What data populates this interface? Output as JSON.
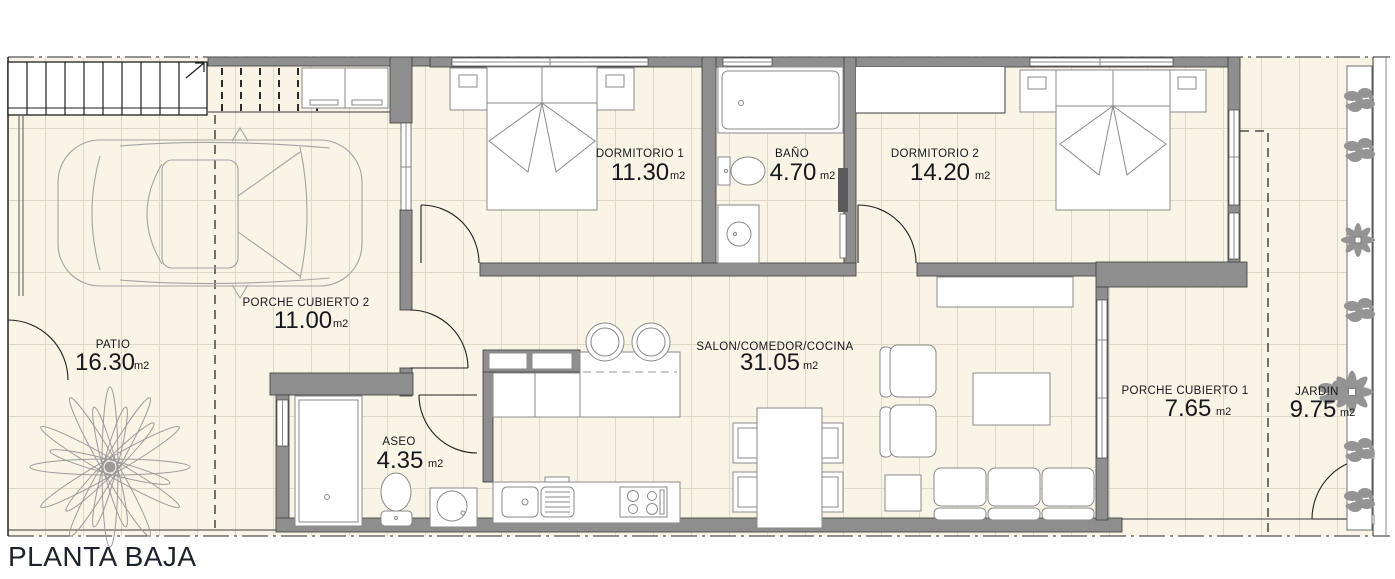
{
  "title": "PLANTA BAJA",
  "rooms": {
    "patio": {
      "name": "PATIO",
      "area": "16.30",
      "unit": "m2"
    },
    "porche2": {
      "name": "PORCHE CUBIERTO 2",
      "area": "11.00",
      "unit": "m2"
    },
    "dormitorio1": {
      "name": "DORMITORIO 1",
      "area": "11.30",
      "unit": "m2"
    },
    "bano": {
      "name": "BAÑO",
      "area": "4.70",
      "unit": "m2"
    },
    "dormitorio2": {
      "name": "DORMITORIO 2",
      "area": "14.20",
      "unit": "m2"
    },
    "salon": {
      "name": "SALON/COMEDOR/COCINA",
      "area": "31.05",
      "unit": "m2"
    },
    "aseo": {
      "name": "ASEO",
      "area": "4.35",
      "unit": "m2"
    },
    "porche1": {
      "name": "PORCHE CUBIERTO 1",
      "area": "7.65",
      "unit": "m2"
    },
    "jardin": {
      "name": "JARDIN",
      "area": "9.75",
      "unit": "m2"
    }
  },
  "colors": {
    "floor": "#FAF4E6",
    "tile_line": "#DED8C6",
    "wall": "#8E8E8E",
    "wall_edge": "#474747",
    "text": "#16181D",
    "furniture_stroke": "#8A8A8A",
    "plant": "#949494"
  }
}
